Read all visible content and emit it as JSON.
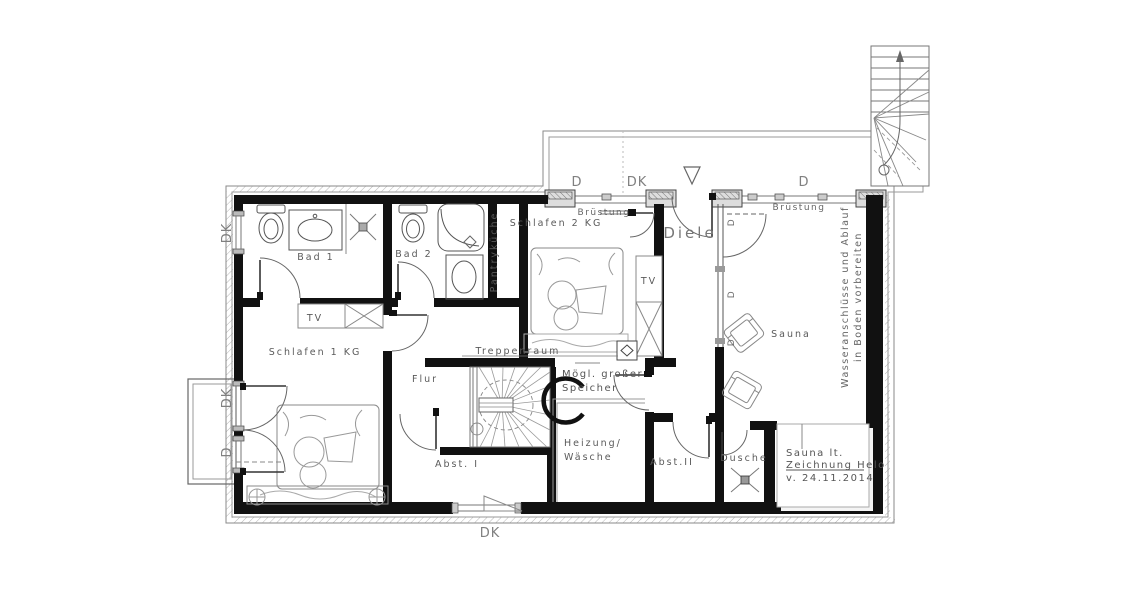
{
  "plan": {
    "labels": {
      "bad1": "Bad 1",
      "bad2": "Bad 2",
      "pantry": "Pantryküche",
      "schlafen1": "Schlafen 1 KG",
      "schlafen2": "Schlafen 2 KG",
      "diele": "Diele",
      "flur": "Flur",
      "sauna": "Sauna",
      "treppenraum": "Treppenraum",
      "speicher1": "Mögl. großer",
      "speicher2": "Speicher",
      "heizung1": "Heizung/",
      "heizung2": "Wäsche",
      "abst1": "Abst. I",
      "abst2": "Abst.II",
      "dusche": "Dusche",
      "tv_schlafen1": "TV",
      "tv_schlafen2": "TV",
      "bruestung_left": "Brüstung",
      "bruestung_right": "Brüstung",
      "win_top_d1": "D",
      "win_top_dk": "DK",
      "win_top_d2": "D",
      "win_left_dk1": "DK",
      "win_left_dk2": "DK",
      "win_left_d": "D",
      "win_bottom_dk": "DK",
      "glass_d1": "D",
      "glass_d2": "D",
      "glass_d3": "D",
      "wasser1": "Wasseranschlüsse und Ablauf",
      "wasser2": "in Boden vorbereiten",
      "note1": "Sauna lt.",
      "note2": "Zeichnung Helo",
      "note3": "v. 24.11.2014"
    },
    "colors": {
      "wall": "#111111",
      "line": "#555555",
      "muted": "#888888",
      "bg": "#ffffff"
    }
  }
}
